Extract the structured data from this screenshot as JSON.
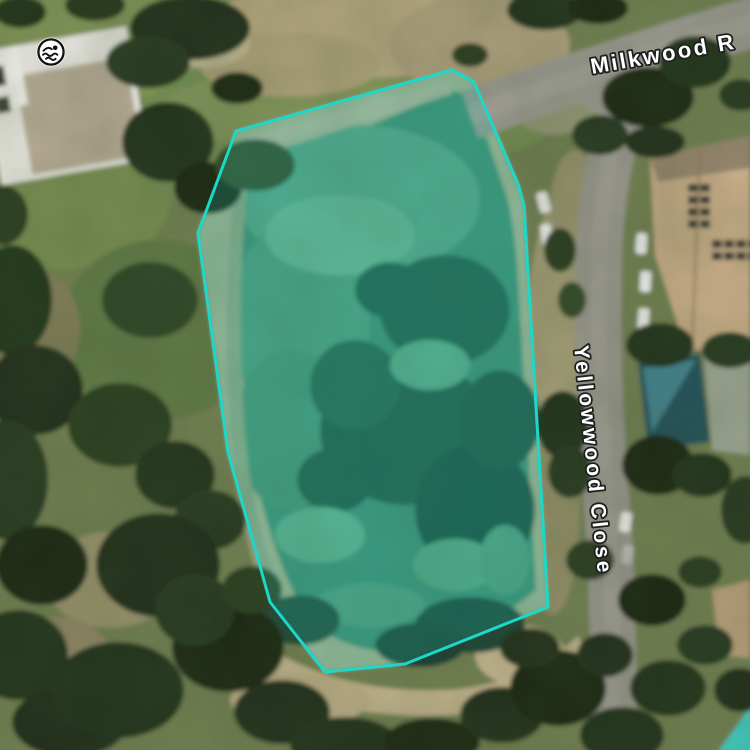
{
  "map_view": {
    "type": "satellite-imagery",
    "street_labels": [
      {
        "id": "milkwood",
        "text": "Milkwood R"
      },
      {
        "id": "yellowwood",
        "text": "Yellowwood Close"
      }
    ],
    "label_style": {
      "fill": "#ffffff",
      "outline": "#1d201e"
    },
    "marker": {
      "kind": "swimming-spot",
      "icon": "swimmer-icon",
      "background": "#ffffff",
      "foreground": "#111111"
    },
    "selection_polygon": {
      "points": "452,70 474,82 518,184 524,206 548,607 405,664 325,672 270,602 228,452 198,233 236,131",
      "stroke": "#1dd8c9",
      "stroke_width": 3,
      "fill": "#1dd8c9",
      "fill_opacity": 0.18
    },
    "terrain_colors": {
      "grass": "#7c9053",
      "sand": "#b2a47d",
      "road": "#96948b",
      "water": "#3a8a6e",
      "water_dark": "#1b5241",
      "tree": "#1a2b12",
      "roof_right_house": "#c9ac86",
      "pool_corner": "#3acdc4"
    }
  }
}
